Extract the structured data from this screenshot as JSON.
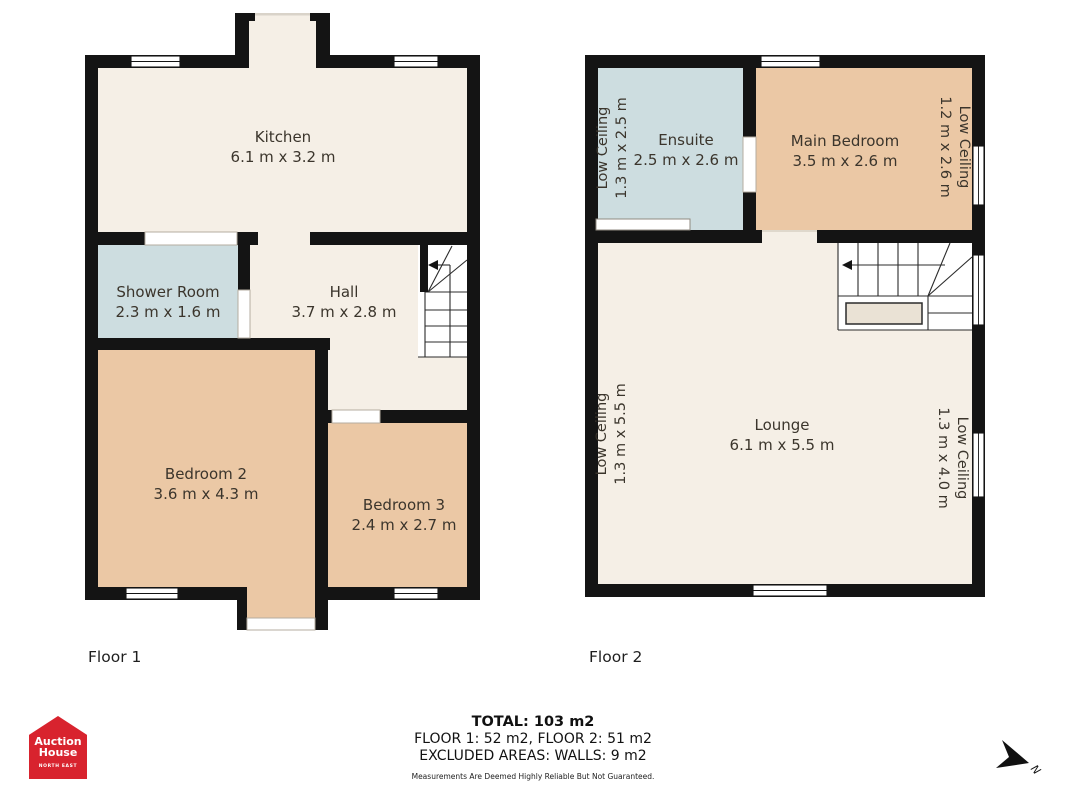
{
  "page": {
    "floor1_label": "Floor 1",
    "floor2_label": "Floor 2"
  },
  "floor1": {
    "kitchen": {
      "name": "Kitchen",
      "dims": "6.1 m x 3.2 m"
    },
    "shower_room": {
      "name": "Shower Room",
      "dims": "2.3 m x 1.6 m"
    },
    "hall": {
      "name": "Hall",
      "dims": "3.7 m x 2.8 m"
    },
    "bedroom2": {
      "name": "Bedroom 2",
      "dims": "3.6 m x 4.3 m"
    },
    "bedroom3": {
      "name": "Bedroom 3",
      "dims": "2.4 m x 2.7 m"
    }
  },
  "floor2": {
    "ensuite": {
      "name": "Ensuite",
      "dims": "2.5 m x 2.6 m",
      "low_ceiling": {
        "label": "Low Ceiling",
        "dims": "1.3 m x 2.5 m"
      }
    },
    "main_bedroom": {
      "name": "Main Bedroom",
      "dims": "3.5 m x 2.6 m",
      "low_ceiling": {
        "label": "Low Ceiling",
        "dims": "1.2 m x 2.6 m"
      }
    },
    "lounge": {
      "name": "Lounge",
      "dims": "6.1 m x 5.5 m",
      "low_ceiling_left": {
        "label": "Low Ceiling",
        "dims": "1.3 m x 5.5 m"
      },
      "low_ceiling_right": {
        "label": "Low Ceiling",
        "dims": "1.3 m x 4.0 m"
      }
    }
  },
  "footer": {
    "total": "TOTAL: 103 m2",
    "floor_areas": "FLOOR 1: 52 m2, FLOOR 2: 51 m2",
    "excluded": "EXCLUDED AREAS: WALLS: 9 m2",
    "disclaimer": "Measurements Are Deemed Highly Reliable But Not Guaranteed."
  },
  "logo": {
    "line1": "Auction",
    "line2": "House",
    "region": "NORTH EAST"
  },
  "compass": {
    "label": "N"
  },
  "colors": {
    "wall": "#141414",
    "room_cream": "#f5efe6",
    "room_tan": "#ebc8a5",
    "room_blue": "#cddde0",
    "brand_red": "#d8232e"
  }
}
